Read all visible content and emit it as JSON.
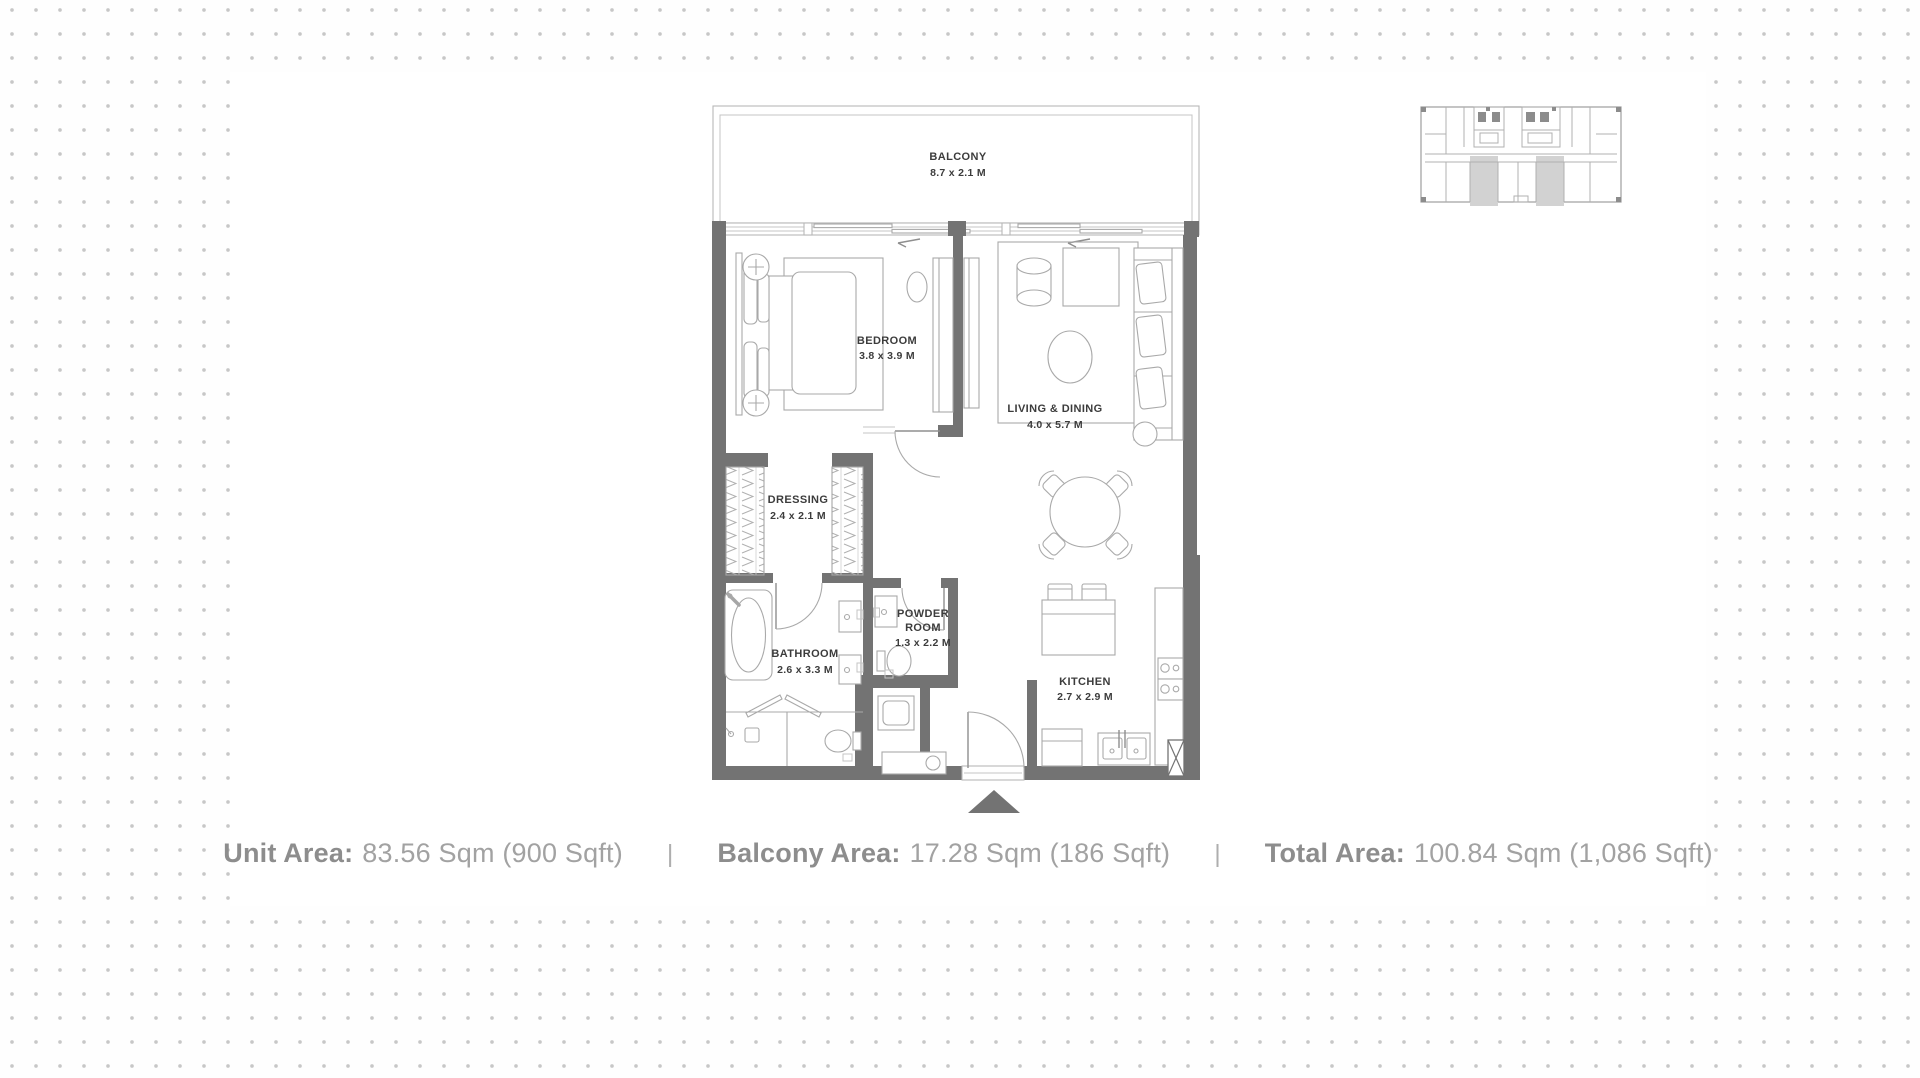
{
  "page": {
    "background_dot_color": "#c7c7c7",
    "wall_color": "#737373",
    "furniture_line_color": "#a9a9a9",
    "label_color": "#3c3c3c",
    "footer_text_color": "#9a9a9a",
    "keyplan_highlight_color": "#d2d2d2"
  },
  "floor_plan": {
    "rooms": [
      {
        "name": "BALCONY",
        "dims": "8.7 x 2.1 M"
      },
      {
        "name": "BEDROOM",
        "dims": "3.8 x 3.9 M"
      },
      {
        "name": "LIVING & DINING",
        "dims": "4.0 x 5.7 M"
      },
      {
        "name": "DRESSING",
        "dims": "2.4 x 2.1 M"
      },
      {
        "name": "BATHROOM",
        "dims": "2.6 x 3.3 M"
      },
      {
        "name_line1": "POWDER",
        "name_line2": "ROOM",
        "dims": "1.3 x 2.2 M"
      },
      {
        "name": "KITCHEN",
        "dims": "2.7 x 2.9 M"
      }
    ]
  },
  "footer": {
    "unit_area_label": "Unit Area:",
    "unit_area_value": "83.56 Sqm (900 Sqft)",
    "separator": "|",
    "balcony_area_label": "Balcony Area:",
    "balcony_area_value": "17.28 Sqm (186 Sqft)",
    "total_area_label": "Total Area:",
    "total_area_value": "100.84 Sqm (1,086 Sqft)"
  }
}
